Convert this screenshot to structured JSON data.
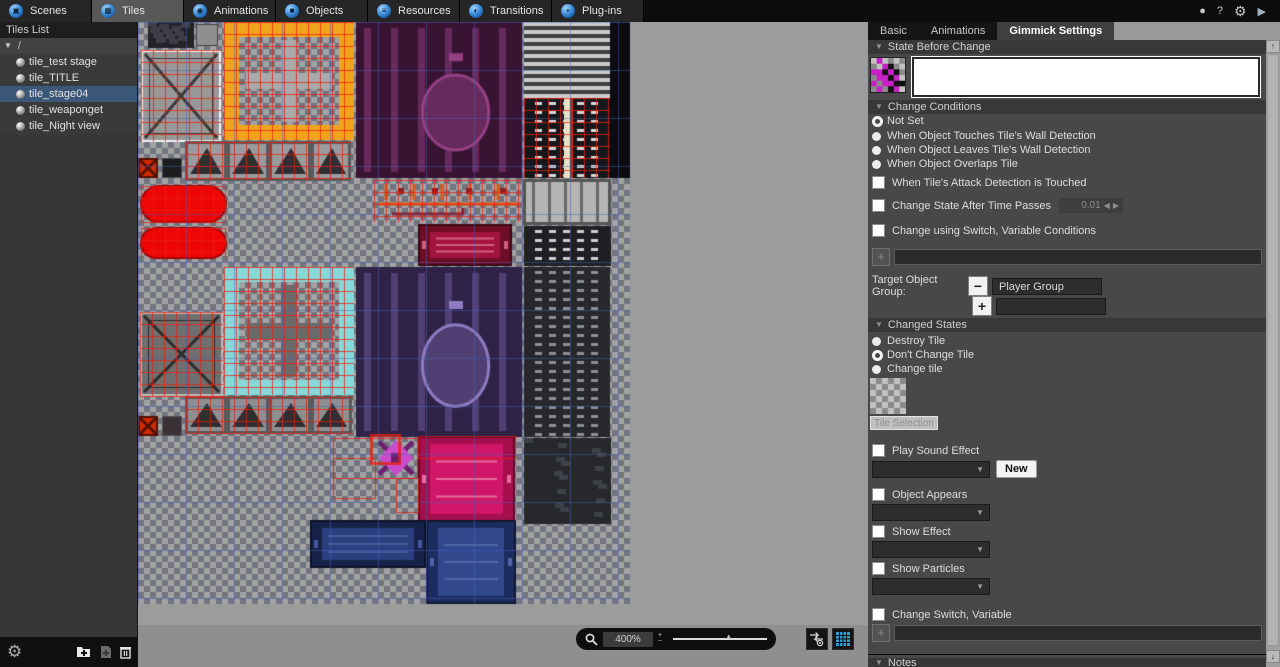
{
  "glyphs": {
    "plus": "+",
    "minus": "−",
    "tri_down": "▼",
    "tri_up": "▲",
    "left": "◀",
    "right": "▶",
    "up": "↑",
    "down": "↓"
  },
  "topbar": {
    "tabs": [
      {
        "label": "Scenes",
        "glyph": "▣"
      },
      {
        "label": "Tiles",
        "glyph": "▦"
      },
      {
        "label": "Animations",
        "glyph": "◉"
      },
      {
        "label": "Objects",
        "glyph": "■"
      },
      {
        "label": "Resources",
        "glyph": "≡"
      },
      {
        "label": "Transitions",
        "glyph": "◐"
      },
      {
        "label": "Plug-ins",
        "glyph": "+"
      }
    ],
    "selected_tab": "Tiles",
    "window_icons": [
      {
        "name": "status-icon",
        "glyph": "●"
      },
      {
        "name": "help-icon",
        "glyph": "?"
      },
      {
        "name": "settings-icon",
        "glyph": "⚙"
      },
      {
        "name": "run-icon",
        "glyph": "▶"
      }
    ]
  },
  "sidebar": {
    "title": "Tiles List",
    "root_label": "/",
    "items": [
      {
        "label": "tile_test stage"
      },
      {
        "label": "tile_TITLE"
      },
      {
        "label": "tile_stage04",
        "selected": true
      },
      {
        "label": "tile_weaponget"
      },
      {
        "label": "tile_Night view"
      }
    ]
  },
  "canvasbar": {
    "zoom_value": "400%"
  },
  "panel": {
    "tabs": [
      {
        "label": "Basic"
      },
      {
        "label": "Animations"
      },
      {
        "label": "Gimmick Settings",
        "selected": true
      }
    ],
    "state_before": {
      "title": "State Before Change"
    },
    "change_conditions": {
      "title": "Change Conditions",
      "radios": [
        {
          "label": "Not Set",
          "selected": true
        },
        {
          "label": "When Object Touches Tile's Wall Detection"
        },
        {
          "label": "When Object Leaves Tile's Wall Detection"
        },
        {
          "label": "When Object Overlaps Tile"
        }
      ],
      "cb_attack": "When Tile's Attack Detection is Touched",
      "cb_time": "Change State After Time Passes",
      "time_value": "0.01",
      "cb_switch": "Change using Switch, Variable Conditions",
      "target_label": "Target Object Group:",
      "target_group": "Player Group"
    },
    "changed_states": {
      "title": "Changed States",
      "radios": [
        {
          "label": "Destroy Tile"
        },
        {
          "label": "Don't Change Tile",
          "selected": true
        },
        {
          "label": "Change tile"
        }
      ],
      "tile_button": "Tile Selection"
    },
    "play_sound": {
      "label": "Play Sound Effect",
      "new_label": "New"
    },
    "object_appears": {
      "label": "Object Appears"
    },
    "show_effect": {
      "label": "Show Effect"
    },
    "show_particles": {
      "label": "Show Particles"
    },
    "change_switch": {
      "label": "Change Switch, Variable"
    },
    "notes": {
      "title": "Notes"
    }
  },
  "tileset": {
    "bg": "#9c9c9c",
    "light": "#a3a3a3",
    "dark": "#71757f",
    "cell": 6,
    "iw": 492,
    "ih": 582,
    "gridStep": 48,
    "gridColor": "rgba(70,95,190,0.5)",
    "redColor": "rgba(235,30,15,0.75)",
    "blocks": [
      {
        "t": "tech",
        "x": 10,
        "y": 0,
        "w": 46,
        "h": 26,
        "a": "#222228",
        "b": "#3e3e48"
      },
      {
        "t": "plain",
        "x": 58,
        "y": 2,
        "w": 22,
        "h": 22,
        "a": "#8f8f8f",
        "b": "#444444"
      },
      {
        "t": "panelx",
        "x": 3,
        "y": 28,
        "w": 80,
        "h": 92,
        "a": "#989898",
        "b": "#f2f2f2",
        "c": "#3a3a3a",
        "r": 1
      },
      {
        "t": "frame",
        "x": 86,
        "y": 0,
        "w": 130,
        "h": 118,
        "a": "#f0a41e",
        "b": "#aaaaaa",
        "cross": 1,
        "r": 1
      },
      {
        "t": "circle",
        "x": 218,
        "y": 0,
        "w": 166,
        "h": 156,
        "a": "#381432",
        "b": "#662a5c",
        "c": "#944084"
      },
      {
        "t": "hstripes",
        "x": 386,
        "y": 0,
        "w": 98,
        "h": 74,
        "a": "#cccccc",
        "b": "#3e3e3e"
      },
      {
        "t": "plain",
        "x": 472,
        "y": 0,
        "w": 20,
        "h": 156,
        "a": "#0c0c10"
      },
      {
        "t": "dashcol",
        "x": 386,
        "y": 76,
        "w": 86,
        "h": 80,
        "a": "#17171b",
        "b": "#d8d8d8",
        "c": "#eadfc4",
        "r": 1
      },
      {
        "t": "tri",
        "x": 48,
        "y": 120,
        "w": 166,
        "h": 38,
        "a": "#9b9b9b",
        "b": "#2f2f2f",
        "r": 1
      },
      {
        "t": "xtile",
        "x": 0,
        "y": 136,
        "w": 20,
        "h": 20,
        "a": "#d42900",
        "b": "#551000"
      },
      {
        "t": "plain",
        "x": 24,
        "y": 136,
        "w": 20,
        "h": 20,
        "a": "#1d1d1f",
        "b": "#454545"
      },
      {
        "t": "pill",
        "x": 3,
        "y": 164,
        "w": 85,
        "h": 36,
        "a": "#ee0606",
        "b": "#a80000",
        "r": 1
      },
      {
        "t": "pill",
        "x": 3,
        "y": 206,
        "w": 85,
        "h": 30,
        "a": "#ee0606",
        "b": "#a80000",
        "r": 1
      },
      {
        "t": "pipes",
        "x": 236,
        "y": 158,
        "w": 148,
        "h": 42,
        "a": "#e05a10",
        "b": "#8c2020",
        "r": 1
      },
      {
        "t": "vstripes",
        "x": 386,
        "y": 158,
        "w": 86,
        "h": 44,
        "a": "#b5b5b5",
        "b": "#6a6a6a"
      },
      {
        "t": "door",
        "x": 280,
        "y": 202,
        "w": 94,
        "h": 42,
        "a": "#6e0d26",
        "b": "#a31340",
        "c": "#d06080"
      },
      {
        "t": "dashcol",
        "x": 386,
        "y": 204,
        "w": 87,
        "h": 40,
        "a": "#202024",
        "b": "#cfcfcf"
      },
      {
        "t": "frame",
        "x": 86,
        "y": 245,
        "w": 130,
        "h": 128,
        "a": "#88d8d8",
        "b": "#6a6a6a",
        "cross": 1,
        "r": 1
      },
      {
        "t": "panelx",
        "x": 2,
        "y": 290,
        "w": 83,
        "h": 84,
        "a": "#6f6f6f",
        "b": "#bbbbbb",
        "c": "#2c2c2c",
        "r": 1
      },
      {
        "t": "circle",
        "x": 218,
        "y": 245,
        "w": 166,
        "h": 170,
        "a": "#2e2346",
        "b": "#4f3f72",
        "c": "#8e7cc2"
      },
      {
        "t": "dashcol",
        "x": 386,
        "y": 245,
        "w": 86,
        "h": 170,
        "a": "#26282c",
        "b": "#8c9096"
      },
      {
        "t": "tri",
        "x": 48,
        "y": 375,
        "w": 167,
        "h": 36,
        "a": "#8f8f8f",
        "b": "#2e2e2e",
        "r": 1
      },
      {
        "t": "xtile",
        "x": 0,
        "y": 394,
        "w": 20,
        "h": 20,
        "a": "#d42900",
        "b": "#551000"
      },
      {
        "t": "plain",
        "x": 24,
        "y": 394,
        "w": 20,
        "h": 20,
        "a": "#3a3136",
        "b": "#555555"
      },
      {
        "t": "crystal",
        "x": 237,
        "y": 416,
        "w": 42,
        "h": 40,
        "a": "#cb4ccb",
        "b": "#6e2070"
      },
      {
        "t": "door",
        "x": 280,
        "y": 414,
        "w": 97,
        "h": 86,
        "a": "#a50f4e",
        "b": "#cf1668",
        "c": "#e86a9a"
      },
      {
        "t": "tech",
        "x": 386,
        "y": 416,
        "w": 87,
        "h": 86,
        "a": "#26282b",
        "b": "#3d4148"
      },
      {
        "t": "door",
        "x": 172,
        "y": 498,
        "w": 116,
        "h": 48,
        "a": "#17224a",
        "b": "#2b3f7e",
        "c": "#46599c"
      },
      {
        "t": "door",
        "x": 288,
        "y": 498,
        "w": 90,
        "h": 84,
        "a": "#1d2c5e",
        "b": "#31498c",
        "c": "#5064a8"
      }
    ],
    "red_boxes": [
      {
        "x": 195,
        "y": 416,
        "w": 84,
        "h": 40,
        "lw": 1
      },
      {
        "x": 195,
        "y": 436,
        "w": 42,
        "h": 40,
        "lw": 1
      },
      {
        "x": 233,
        "y": 413,
        "w": 28,
        "h": 28,
        "lw": 3
      },
      {
        "x": 258,
        "y": 456,
        "w": 22,
        "h": 34,
        "lw": 1
      },
      {
        "x": 280,
        "y": 414,
        "w": 97,
        "h": 22,
        "lw": 1
      }
    ]
  }
}
